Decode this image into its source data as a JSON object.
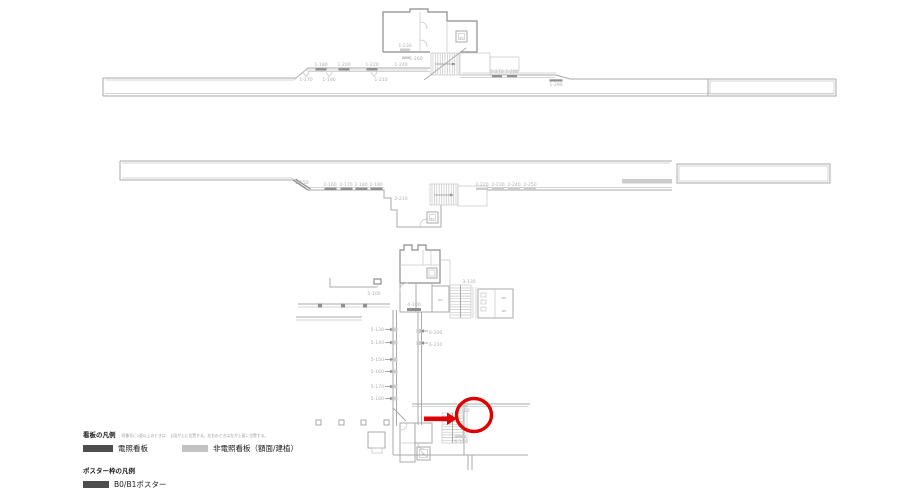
{
  "colors": {
    "line": "#a9a9a9",
    "lite": "#c6c6c6",
    "wall": "#8c8c8c",
    "label": "#b0b0b0",
    "sign_dark": "#8f8f8f",
    "sign_gray": "#cccccc",
    "red": "#e00000",
    "legend_dark": "#4d4d4d",
    "legend_gray": "#c2c2c2",
    "text": "#1a1a1a",
    "note": "#9a9a9a"
  },
  "p1": [
    "1-180",
    "1-200",
    "1-220",
    "1-170",
    "1-190",
    "1-210",
    "1-230",
    "1-260",
    "1-240",
    "1-270",
    "1-280",
    "1-290"
  ],
  "p2": [
    "2-150",
    "2-160",
    "2-170",
    "2-180",
    "2-190",
    "2-210",
    "2-220",
    "2-230",
    "2-240",
    "2-250"
  ],
  "c": [
    "5-100",
    "3-130",
    "4-100",
    "6-200",
    "6-210",
    "5-130",
    "5-140",
    "5-150",
    "5-160",
    "5-170",
    "5-180",
    "6-120",
    "6-130"
  ],
  "rooms": {
    "ev": "EV",
    "wc": "WC"
  },
  "legend": {
    "sign_title": "看板の凡例",
    "sign_note": "同番号に2面以上のときは、上段が上に位置する。左右のときは左が上面に位置する。",
    "item_lit": "電照看板",
    "item_unlit": "非電照看板（額面/建植）",
    "poster_title": "ポスター枠の凡例",
    "poster_item": "B0/B1ポスター"
  }
}
